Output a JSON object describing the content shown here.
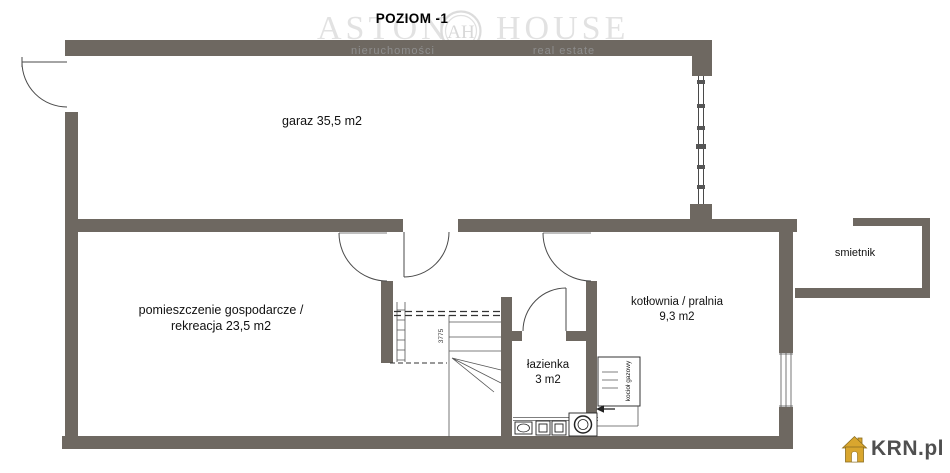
{
  "page": {
    "title": "POZIOM -1"
  },
  "watermark": {
    "brand_word_1": "ASTON",
    "brand_word_2": "HOUSE",
    "monogram": "AH",
    "tagline_left": "nieruchomości",
    "tagline_right": "real estate"
  },
  "rooms": {
    "garage": {
      "label": "garaz 35,5 m2"
    },
    "utility": {
      "line1": "pomieszczenie gospodarcze /",
      "line2": "rekreacja 23,5 m2"
    },
    "boiler_laundry": {
      "line1": "kotłownia / pralnia",
      "line2": "9,3 m2"
    },
    "bathroom": {
      "line1": "łazienka",
      "line2": "3 m2"
    },
    "trash_shed": {
      "label": "smietnik"
    }
  },
  "annotations": {
    "gas_boiler_label": "kocioł gazowy",
    "stair_dimension": "3775"
  },
  "branding_footer": {
    "site_logo_text": "KRN.pl"
  },
  "colors": {
    "wall": "#6e6861",
    "thin_line": "#4a4a4a",
    "watermark_gray": "#e2e2e2",
    "logo_gold": "#d9a62e",
    "title_black": "#000000"
  }
}
